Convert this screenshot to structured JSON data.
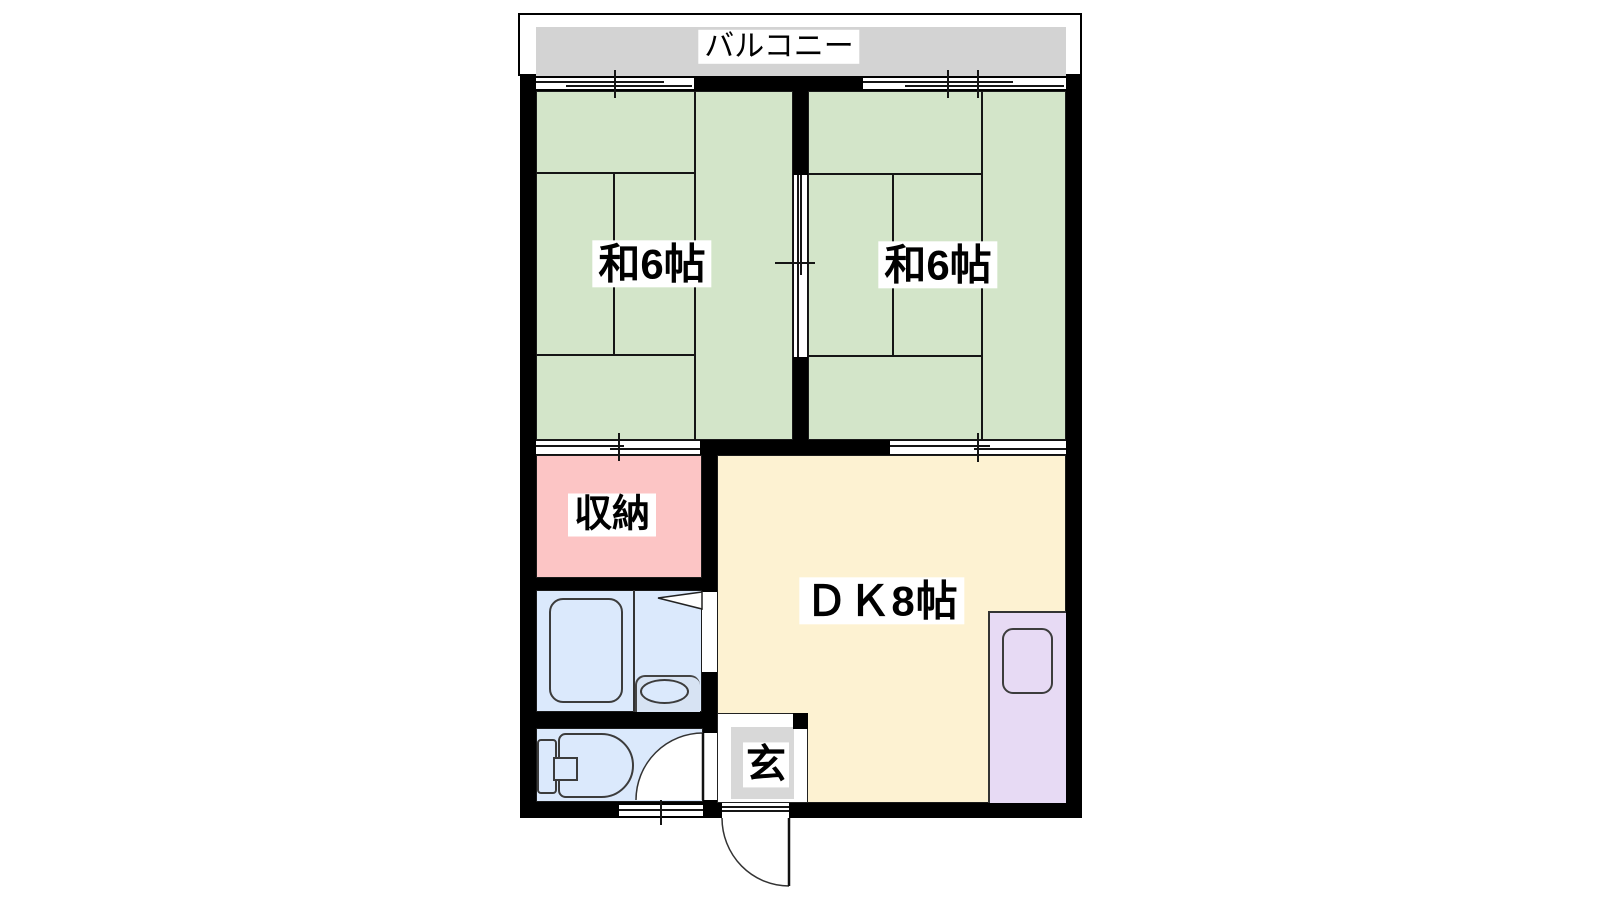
{
  "floorplan": {
    "balcony": {
      "label": "バルコニー"
    },
    "rooms": {
      "japanese_left": {
        "label": "和6帖"
      },
      "japanese_right": {
        "label": "和6帖"
      },
      "storage": {
        "label": "収納"
      },
      "dining_kitchen": {
        "label": "ＤＫ8帖"
      },
      "entrance": {
        "label": "玄"
      }
    },
    "colors": {
      "tatami": "#d3e5c9",
      "storage": "#fcc5c5",
      "bath": "#dbe9fc",
      "basin_area": "#d7e3f3",
      "dining_kitchen": "#fdf2d2",
      "kitchen_counter": "#e7daf4",
      "balcony": "#d3d3d3",
      "entrance_tile": "#d8d8d8",
      "wall": "#000000"
    }
  }
}
